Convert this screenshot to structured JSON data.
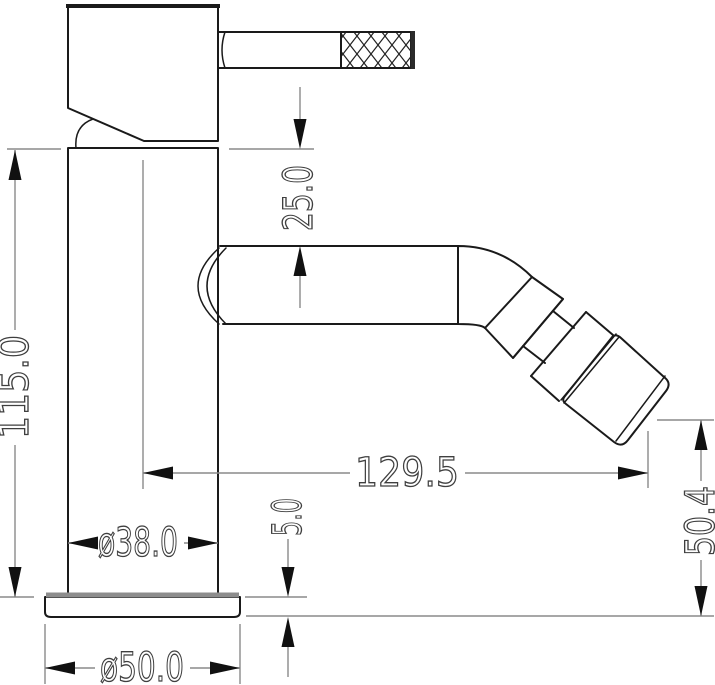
{
  "drawing": {
    "type": "technical-drawing",
    "subject": "single-lever bidet mixer tap, side elevation with dimensions",
    "colors": {
      "object_line": "#1a1a1a",
      "dimension_line": "#8a8a8a",
      "arrow": "#111111",
      "text": "#3f3f3f",
      "background": "#ffffff"
    },
    "dimensions": {
      "overall_height": "115.0",
      "spout_drop": "25.0",
      "spout_reach": "129.5",
      "outlet_height": "50.4",
      "base_thickness": "5.0",
      "body_diameter": "ø38.0",
      "base_diameter": "ø50.0"
    }
  }
}
